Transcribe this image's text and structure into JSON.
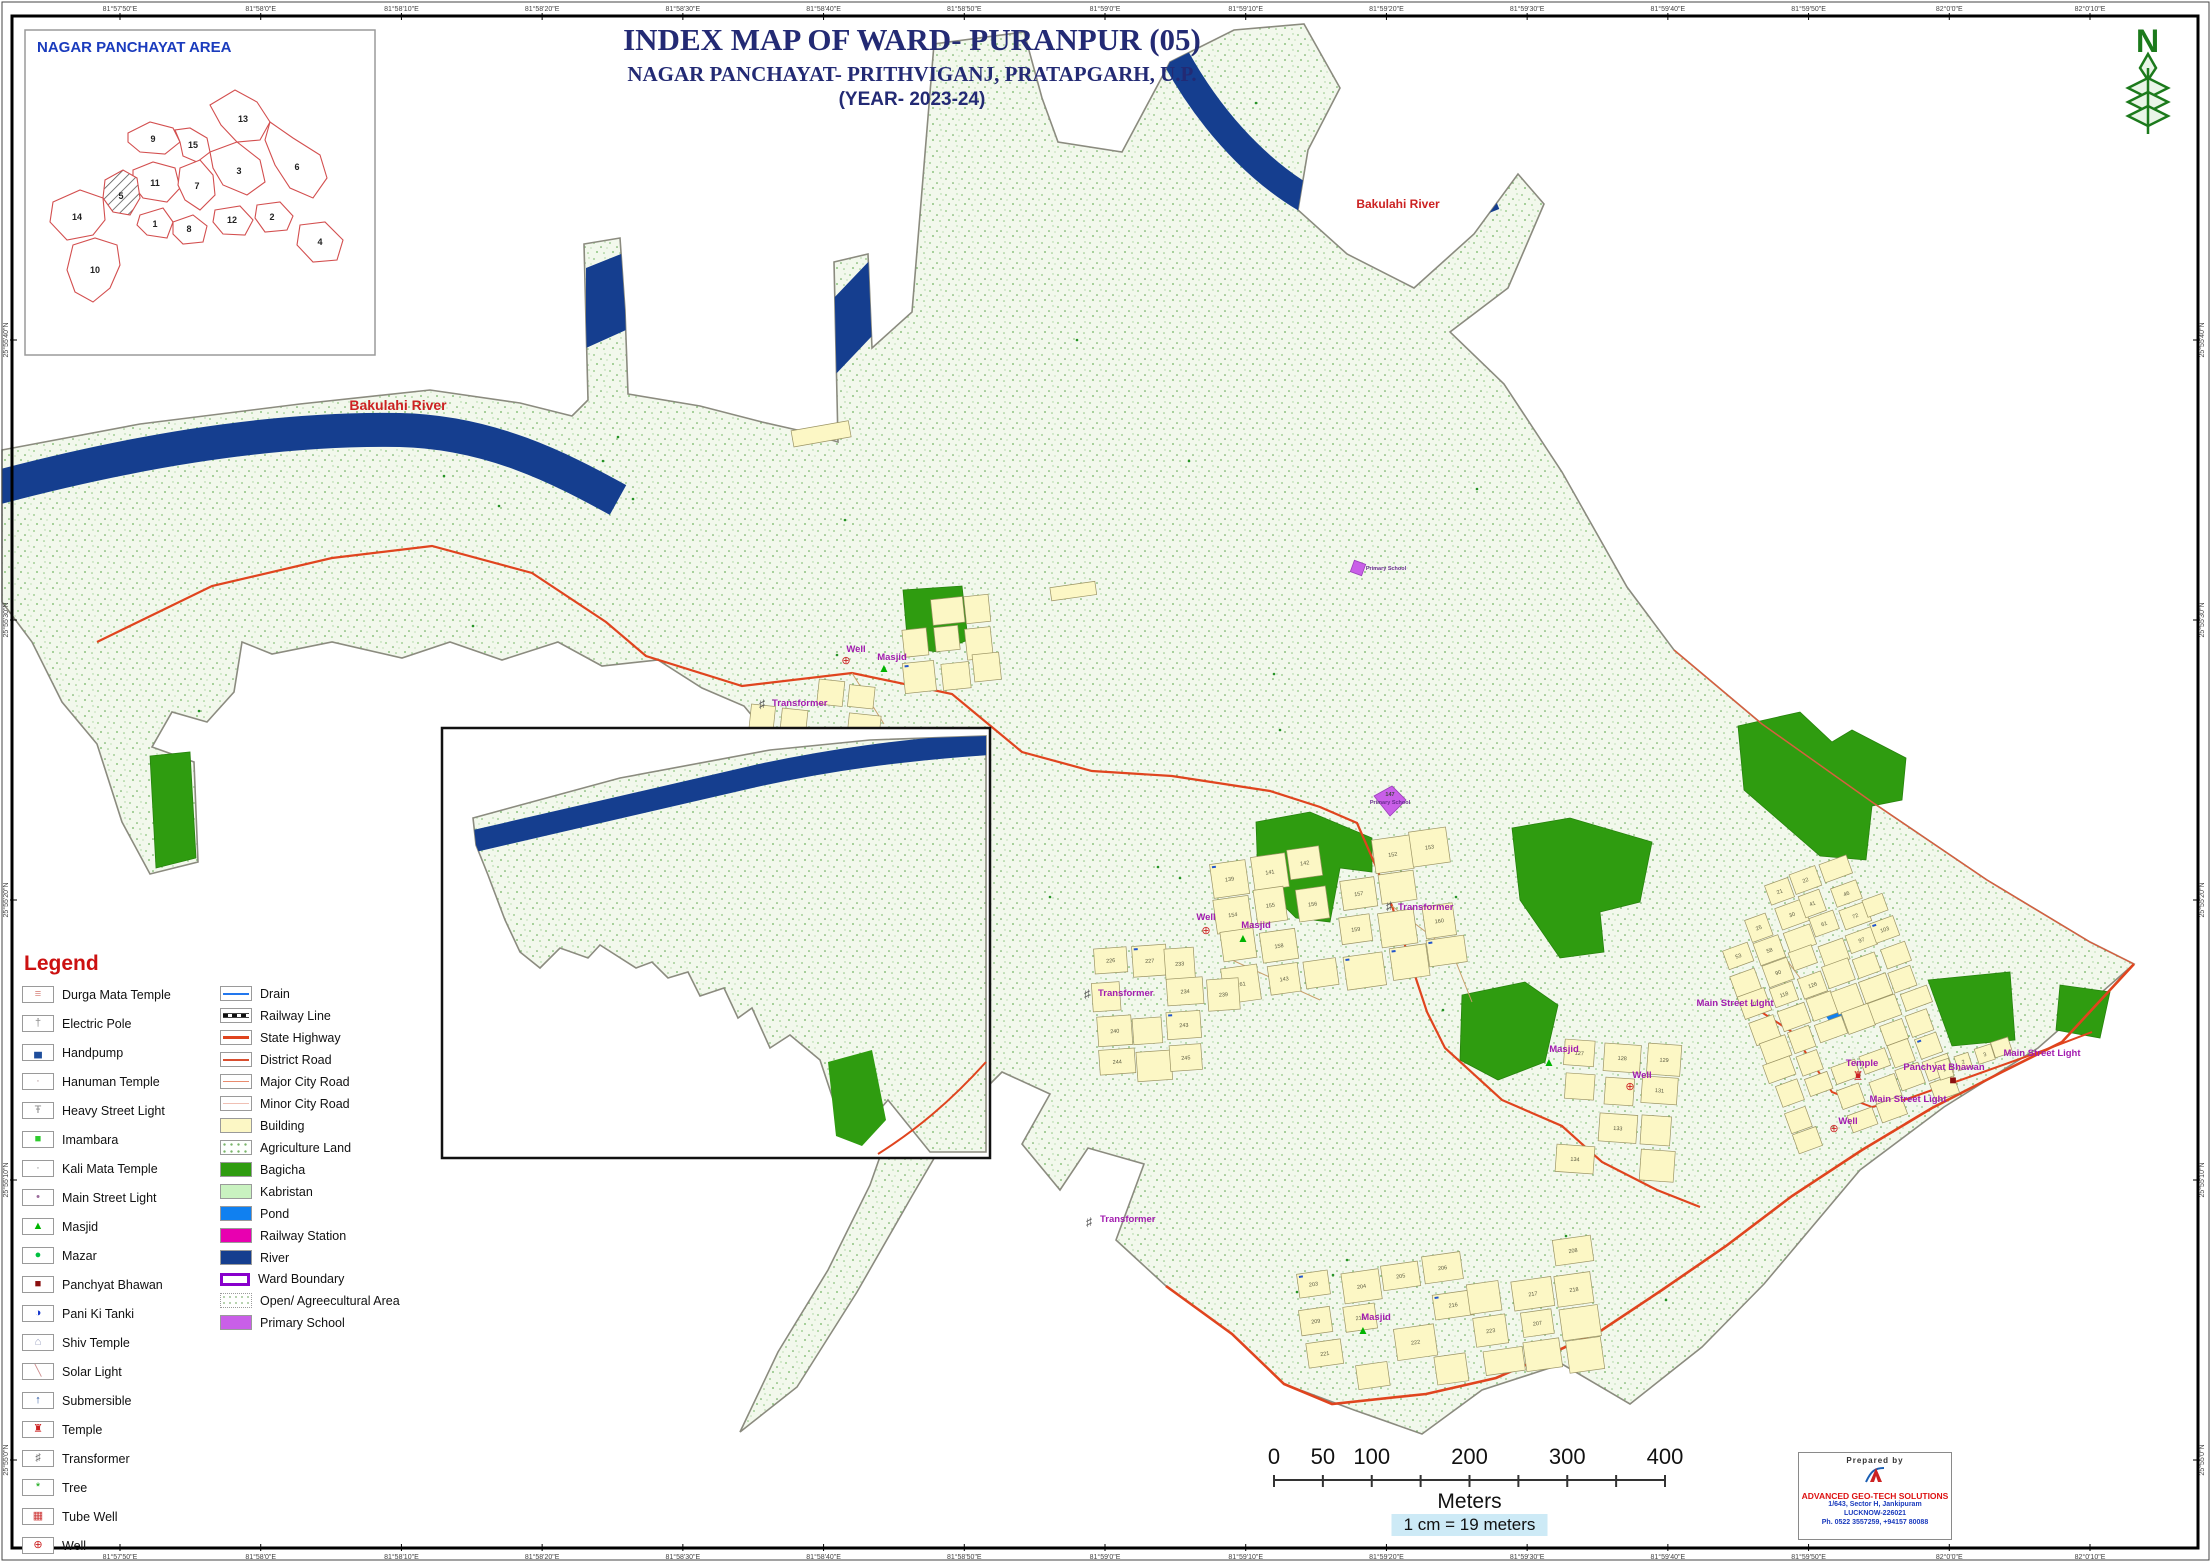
{
  "title": {
    "line1": "INDEX MAP OF WARD- PURANPUR (05)",
    "line2": "NAGAR PANCHAYAT- PRITHVIGANJ, PRATAPGARH, U.P.",
    "line3": "(YEAR- 2023-24)"
  },
  "north_label": "N",
  "inset_overview": {
    "title": "NAGAR PANCHAYAT AREA",
    "highlighted_ward": "5",
    "wards": [
      {
        "num": "9",
        "x": 128,
        "y": 112
      },
      {
        "num": "15",
        "x": 168,
        "y": 118
      },
      {
        "num": "13",
        "x": 218,
        "y": 92
      },
      {
        "num": "3",
        "x": 214,
        "y": 144
      },
      {
        "num": "6",
        "x": 272,
        "y": 140
      },
      {
        "num": "11",
        "x": 130,
        "y": 156
      },
      {
        "num": "7",
        "x": 172,
        "y": 159
      },
      {
        "num": "5",
        "x": 96,
        "y": 169
      },
      {
        "num": "14",
        "x": 52,
        "y": 190
      },
      {
        "num": "1",
        "x": 130,
        "y": 197
      },
      {
        "num": "8",
        "x": 164,
        "y": 202
      },
      {
        "num": "12",
        "x": 207,
        "y": 193
      },
      {
        "num": "2",
        "x": 247,
        "y": 190
      },
      {
        "num": "4",
        "x": 295,
        "y": 215
      },
      {
        "num": "10",
        "x": 70,
        "y": 243
      }
    ]
  },
  "graticule": {
    "top": [
      "81°57'50\"E",
      "81°58'0\"E",
      "81°58'10\"E",
      "81°58'20\"E",
      "81°58'30\"E",
      "81°58'40\"E",
      "81°58'50\"E",
      "81°59'0\"E",
      "81°59'10\"E",
      "81°59'20\"E",
      "81°59'30\"E",
      "81°59'40\"E",
      "81°59'50\"E",
      "82°0'0\"E",
      "82°0'10\"E"
    ],
    "bottom": [
      "81°57'50\"E",
      "81°58'0\"E",
      "81°58'10\"E",
      "81°58'20\"E",
      "81°58'30\"E",
      "81°58'40\"E",
      "81°58'50\"E",
      "81°59'0\"E",
      "81°59'10\"E",
      "81°59'20\"E",
      "81°59'30\"E",
      "81°59'40\"E",
      "81°59'50\"E",
      "82°0'0\"E",
      "82°0'10\"E"
    ],
    "left": [
      "25°55'40\"N",
      "25°55'30\"N",
      "25°55'20\"N",
      "25°55'10\"N",
      "25°55'0\"N"
    ],
    "right": [
      "25°55'40\"N",
      "25°55'30\"N",
      "25°55'20\"N",
      "25°55'10\"N",
      "25°55'0\"N"
    ]
  },
  "map": {
    "river_labels": [
      {
        "text": "Bakulahi River",
        "x": 398,
        "y": 410,
        "size": 14
      },
      {
        "text": "Bakulahi River",
        "x": 1398,
        "y": 208,
        "size": 12
      },
      {
        "text": "Bakulahi River",
        "x": 646,
        "y": 814,
        "size": 12
      }
    ],
    "feature_labels": [
      {
        "text": "Main Street Light",
        "x": 1735,
        "y": 1006
      },
      {
        "text": "Main Street Light",
        "x": 2042,
        "y": 1056
      },
      {
        "text": "Main Street Light",
        "x": 1908,
        "y": 1102
      },
      {
        "text": "Temple",
        "x": 1862,
        "y": 1066
      },
      {
        "text": "Panchyat Bhawan",
        "x": 1944,
        "y": 1070
      },
      {
        "text": "Well",
        "x": 1206,
        "y": 920
      },
      {
        "text": "Well",
        "x": 1642,
        "y": 1078
      },
      {
        "text": "Well",
        "x": 1848,
        "y": 1124
      },
      {
        "text": "Well",
        "x": 856,
        "y": 652
      },
      {
        "text": "Masjid",
        "x": 1256,
        "y": 928
      },
      {
        "text": "Masjid",
        "x": 1564,
        "y": 1052
      },
      {
        "text": "Masjid",
        "x": 1376,
        "y": 1320
      },
      {
        "text": "Masjid",
        "x": 892,
        "y": 660
      },
      {
        "text": "Transformer",
        "x": 1398,
        "y": 910,
        "anchor": "start"
      },
      {
        "text": "Transformer",
        "x": 1098,
        "y": 996,
        "anchor": "start"
      },
      {
        "text": "Transformer",
        "x": 1100,
        "y": 1222,
        "anchor": "start"
      },
      {
        "text": "Transformer",
        "x": 772,
        "y": 706,
        "anchor": "start"
      },
      {
        "text": "147",
        "x": 1390,
        "y": 796,
        "size": 5.5,
        "color": "#444444"
      },
      {
        "text": "Primary School",
        "x": 1390,
        "y": 804,
        "size": 5.5,
        "color": "#6a2d91"
      },
      {
        "text": "Primary School",
        "x": 1386,
        "y": 570,
        "size": 5.5,
        "color": "#6a2d91"
      }
    ],
    "markers": [
      {
        "type": "masjid",
        "x": 1243,
        "y": 942
      },
      {
        "type": "masjid",
        "x": 1549,
        "y": 1066
      },
      {
        "type": "masjid",
        "x": 1363,
        "y": 1334
      },
      {
        "type": "masjid",
        "x": 884,
        "y": 672
      },
      {
        "type": "well",
        "x": 1206,
        "y": 934
      },
      {
        "type": "well",
        "x": 1630,
        "y": 1090
      },
      {
        "type": "well",
        "x": 1834,
        "y": 1132
      },
      {
        "type": "well",
        "x": 846,
        "y": 664
      },
      {
        "type": "transformer",
        "x": 1389,
        "y": 910
      },
      {
        "type": "transformer",
        "x": 1087,
        "y": 998
      },
      {
        "type": "transformer",
        "x": 1089,
        "y": 1226
      },
      {
        "type": "transformer",
        "x": 762,
        "y": 708
      },
      {
        "type": "temple",
        "x": 1858,
        "y": 1080
      },
      {
        "type": "panchyat",
        "x": 1953,
        "y": 1084
      },
      {
        "type": "school",
        "x": 1358,
        "y": 570
      }
    ],
    "parcel_numbers": {
      "c1": [
        "21",
        "22",
        "25",
        "30",
        "41",
        "46",
        "53",
        "58",
        "61",
        "72",
        "90",
        "97",
        "103",
        "107",
        "118",
        "126"
      ],
      "c1b": [
        "1",
        "2",
        "3"
      ],
      "c2": [
        "139",
        "141",
        "142",
        "152",
        "153",
        "154",
        "155",
        "156",
        "157",
        "158",
        "159",
        "160",
        "161",
        "143"
      ],
      "c3": [
        "226",
        "227",
        "233",
        "234",
        "239",
        "240",
        "243",
        "244",
        "245",
        "252"
      ],
      "c4": [
        "203",
        "204",
        "205",
        "206",
        "208",
        "209",
        "213",
        "216",
        "217",
        "218",
        "221",
        "222",
        "223",
        "207"
      ],
      "c5": [
        "127",
        "128",
        "129",
        "131",
        "133",
        "134",
        "137",
        "163",
        "183"
      ]
    }
  },
  "legend": {
    "title": "Legend",
    "point_items": [
      {
        "label": "Durga Mata Temple",
        "glyph": "≡",
        "color": "#d98880"
      },
      {
        "label": "Electric Pole",
        "glyph": "†",
        "color": "#8a8a8a"
      },
      {
        "label": "Handpump",
        "glyph": "▄",
        "color": "#1f4e9c"
      },
      {
        "label": "Hanuman Temple",
        "glyph": "·",
        "color": "#aa8888"
      },
      {
        "label": "Heavy Street Light",
        "glyph": "Ŧ",
        "color": "#8a8a8a"
      },
      {
        "label": "Imambara",
        "glyph": "■",
        "color": "#2ecc2e"
      },
      {
        "label": "Kali Mata Temple",
        "glyph": "·",
        "color": "#888888"
      },
      {
        "label": "Main Street Light",
        "glyph": "•",
        "color": "#9a6a9a"
      },
      {
        "label": "Masjid",
        "glyph": "▲",
        "color": "#00b400"
      },
      {
        "label": "Mazar",
        "glyph": "●",
        "color": "#00c040"
      },
      {
        "label": "Panchyat Bhawan",
        "glyph": "■",
        "color": "#8b0f0f"
      },
      {
        "label": "Pani Ki Tanki",
        "glyph": "◑",
        "color": "#1133cc"
      },
      {
        "label": "Shiv Temple",
        "glyph": "⌂",
        "color": "#9aa0c0"
      },
      {
        "label": "Solar Light",
        "glyph": "╲",
        "color": "#cc8888"
      },
      {
        "label": "Submersible",
        "glyph": "↑",
        "color": "#1f4e9c"
      },
      {
        "label": "Temple",
        "glyph": "♜",
        "color": "#cc2222"
      },
      {
        "label": "Transformer",
        "glyph": "♯",
        "color": "#666666"
      },
      {
        "label": "Tree",
        "glyph": "*",
        "color": "#00a000"
      },
      {
        "label": "Tube Well",
        "glyph": "▦",
        "color": "#cc3333"
      },
      {
        "label": "Well",
        "glyph": "⊕",
        "color": "#cc2222"
      }
    ],
    "area_items": [
      {
        "label": "Drain",
        "type": "drain"
      },
      {
        "label": "Railway Line",
        "type": "railway"
      },
      {
        "label": "State Highway",
        "type": "statehwy"
      },
      {
        "label": "District Road",
        "type": "district"
      },
      {
        "label": "Major City Road",
        "type": "major"
      },
      {
        "label": "Minor City Road",
        "type": "minor"
      },
      {
        "label": "Building",
        "type": "building"
      },
      {
        "label": "Agriculture Land",
        "type": "agri"
      },
      {
        "label": "Bagicha",
        "type": "bagicha"
      },
      {
        "label": "Kabristan",
        "type": "kabristan"
      },
      {
        "label": "Pond",
        "type": "pond"
      },
      {
        "label": "Railway Station",
        "type": "railstation"
      },
      {
        "label": "River",
        "type": "river"
      },
      {
        "label": "Ward Boundary",
        "type": "wardboundary"
      },
      {
        "label": "Open/ Agreecultural Area",
        "type": "open"
      },
      {
        "label": "Primary School",
        "type": "primaryschool"
      }
    ]
  },
  "scale_bar": {
    "major_labels": [
      "0",
      "50",
      "100",
      "200",
      "300",
      "400"
    ],
    "major_values": [
      0,
      50,
      100,
      200,
      300,
      400
    ],
    "all_ticks": [
      0,
      50,
      100,
      150,
      200,
      250,
      300,
      350,
      400
    ],
    "unit": "Meters",
    "note": "1 cm = 19 meters"
  },
  "credits": {
    "prepared_by": "Prepared  by",
    "company": "ADVANCED GEO-TECH SOLUTIONS",
    "address1": "1/643, Sector H, Jankipuram",
    "address2": "LUCKNOW-226021",
    "phone": "Ph. 0522 3557259, +94157 80088"
  },
  "colors": {
    "river": "#153e8f",
    "state_highway": "#e0441e",
    "building_fill": "#FCF7C5",
    "bagicha": "#2f9c10",
    "pond": "#1080f0",
    "primary_school": "#c95fe8",
    "label_magenta": "#A21CAF",
    "title_navy": "#232a74",
    "legend_red": "#cc1111"
  }
}
